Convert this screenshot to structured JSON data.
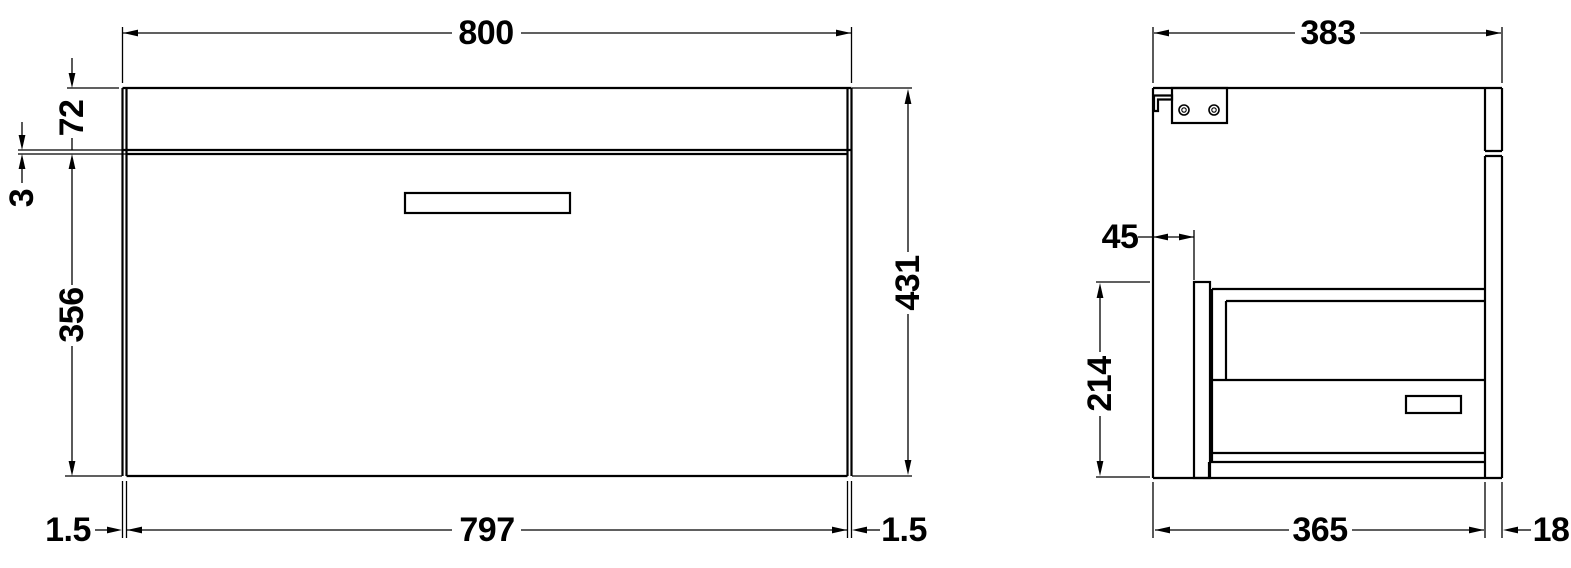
{
  "front_view": {
    "dims": {
      "top_width": "800",
      "worktop_height": "72",
      "worktop_gap": "3",
      "cabinet_height": "356",
      "overall_height": "431",
      "cabinet_width": "797",
      "overhang_left": "1.5",
      "overhang_right": "1.5"
    }
  },
  "side_view": {
    "dims": {
      "top_depth": "383",
      "wall_offset": "45",
      "back_rail_height": "214",
      "body_depth": "365",
      "front_panel_thickness": "18"
    }
  },
  "colors": {
    "line": "#000000",
    "background": "#ffffff"
  }
}
